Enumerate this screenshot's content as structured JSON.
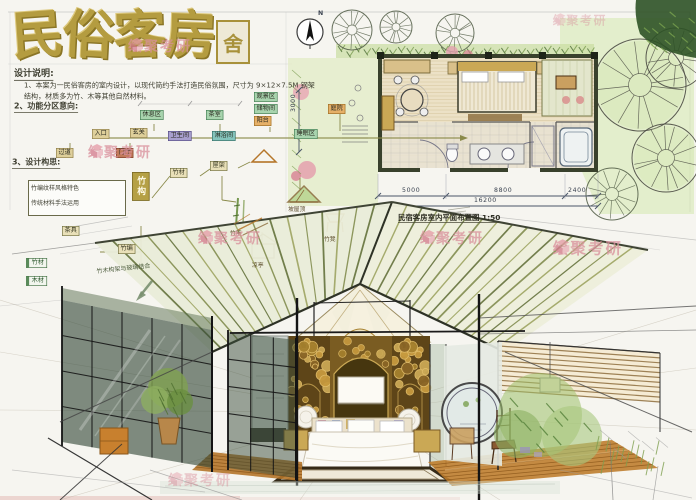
{
  "title": {
    "chars": [
      "民",
      "俗",
      "客",
      "房"
    ],
    "seal": "舍"
  },
  "watermark": {
    "text": "绘聚考研"
  },
  "notes": {
    "heading": "设计说明:",
    "line1": "1、本案为一民俗客房的室内设计，以现代简约手法打造民俗氛围，尺寸为 9×12×7.5M 钢架",
    "line2": "结构，材质多为竹、木等其他自然材料。",
    "section2": "2、功能分区意向:",
    "section3": "3、设计构思:",
    "concept_note1": "竹编纹样风格特色",
    "concept_note2": "传统材料手法运用",
    "annotation": "竹木构架与玻璃结合"
  },
  "flow": {
    "boxes": [
      {
        "label": "入口",
        "color": "tan"
      },
      {
        "label": "玄关",
        "color": "tan"
      },
      {
        "label": "卫生间",
        "color": "purple"
      },
      {
        "label": "淋浴间",
        "color": "teal"
      },
      {
        "label": "睡眠区",
        "color": "green"
      },
      {
        "label": "休息区",
        "color": "green"
      },
      {
        "label": "茶室",
        "color": "green"
      },
      {
        "label": "观景区",
        "color": "green"
      },
      {
        "label": "储物间",
        "color": "green"
      },
      {
        "label": "阳台",
        "color": "orange"
      },
      {
        "label": "庭院",
        "color": "orange"
      },
      {
        "label": "过道",
        "color": "tan"
      },
      {
        "label": "门厅",
        "color": "brown"
      }
    ]
  },
  "concept": {
    "nodes": [
      "竹构",
      "竹材",
      "屋架",
      "茶具",
      "竹编"
    ],
    "materials": [
      "竹材",
      "木材"
    ],
    "captions": [
      "坡屋顶",
      "竹竿",
      "竹凳",
      "凉亭"
    ]
  },
  "plan": {
    "north": "N",
    "dims": {
      "d1": "5000",
      "d2": "8800",
      "d3": "2400",
      "total": "16200",
      "side": "3000"
    },
    "title": "民宿客房室内平面布置图 1:50"
  },
  "colors": {
    "title_gold": "#b49c40",
    "watermark_pink": "#d98f9b",
    "roof_olive": "#7c8747",
    "wood_brown": "#bf7e2f",
    "glass_green": "#3a4a3c",
    "plan_green": "#cfe3a8"
  }
}
